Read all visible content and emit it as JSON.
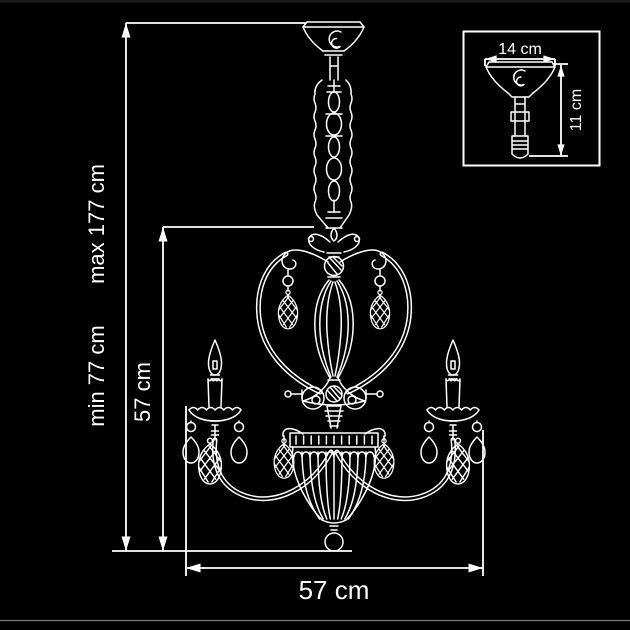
{
  "page": {
    "background_color": "#000000",
    "line_color": "#ffffff"
  },
  "diagram": {
    "kind": "chandelier dimension drawing",
    "labels": {
      "max_height": "max 177 cm",
      "min_height": "min 77 cm",
      "body_height": "57 cm",
      "body_width": "57 cm"
    },
    "inset": {
      "canopy_width": "14 cm",
      "canopy_height": "11 cm"
    }
  }
}
